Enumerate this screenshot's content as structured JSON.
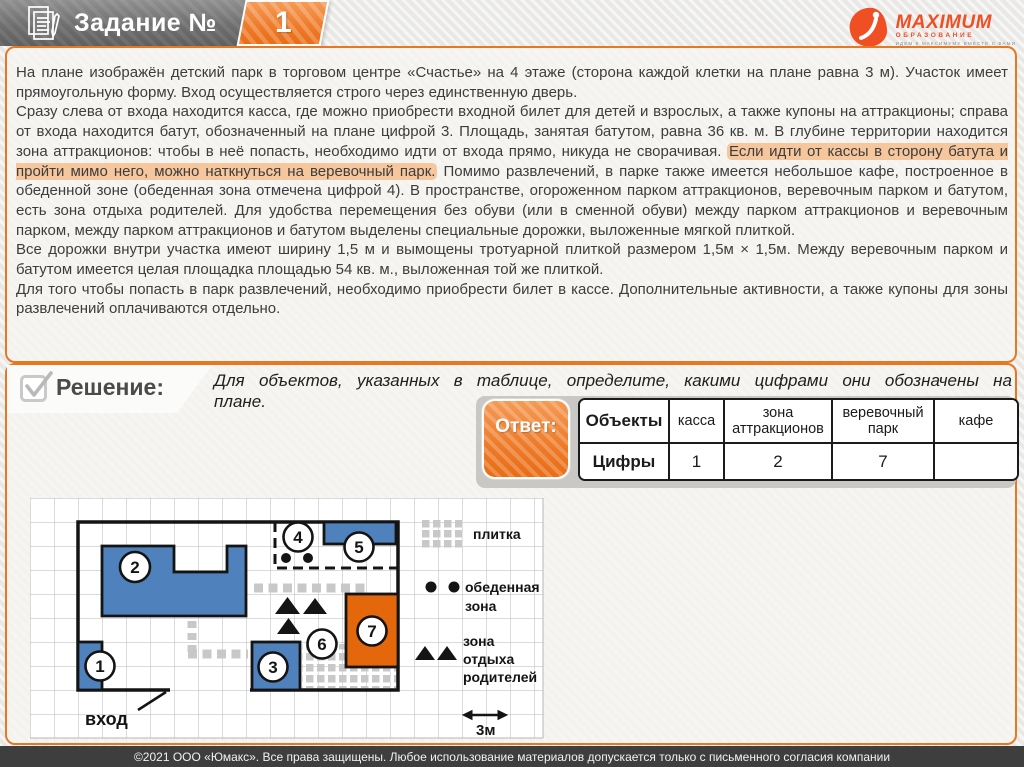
{
  "header": {
    "task_label": "Задание №",
    "task_number": "1",
    "logo_brand": "MAXIMUM",
    "logo_sub": "ОБРАЗОВАНИЕ",
    "logo_tagline": "ИДЕМ К МАКСИМУМУ ВМЕСТЕ С ВАМИ"
  },
  "task": {
    "paragraphs": [
      {
        "runs": [
          {
            "t": "На плане изображён детский парк в торговом центре «Счастье» на 4 этаже (сторона каждой клетки на плане равна 3 м). Участок имеет прямоугольную форму. Вход осуществляется строго через единственную дверь."
          }
        ]
      },
      {
        "runs": [
          {
            "t": "Сразу слева от входа находится касса, где можно приобрести входной билет для детей и взрослых, а также купоны на аттракционы; справа от входа находится батут, обозначенный на плане цифрой 3. Площадь, занятая батутом, равна 36 кв. м. В глубине территории находится зона аттракционов: чтобы в неё попасть, необходимо идти от входа прямо, никуда не сворачивая. "
          },
          {
            "t": "Если идти от кассы в сторону батута и пройти мимо него, можно наткнуться на веревочный парк.",
            "hl": true
          },
          {
            "t": " Помимо развлечений, в парке также имеется небольшое кафе, построенное в обеденной зоне (обеденная зона отмечена цифрой 4). В пространстве, огороженном парком аттракционов, веревочным парком и батутом, есть зона отдыха родителей. Для удобства перемещения без обуви (или в сменной обуви) между парком аттракционов и веревочным парком, между парком аттракционов и батутом выделены специальные дорожки, выложенные мягкой плиткой."
          }
        ]
      },
      {
        "runs": [
          {
            "t": "Все дорожки внутри участка имеют ширину 1,5 м и вымощены тротуарной плиткой размером 1,5м × 1,5м.  Между веревочным парком и батутом имеется целая площадка площадью 54 кв. м., выложенная той же плиткой."
          }
        ]
      },
      {
        "runs": [
          {
            "t": "Для того чтобы попасть в парк развлечений, необходимо приобрести билет в кассе. Дополнительные активности, а также купоны для зоны развлечений оплачиваются отдельно."
          }
        ]
      }
    ]
  },
  "solution": {
    "label": "Решение:",
    "prompt_line1": "Для объектов, указанных в таблице, определите, какими цифрами они обозначены на",
    "prompt_line2": "плане."
  },
  "answer": {
    "button_label": "Ответ:",
    "table": {
      "row1_label": "Объекты",
      "row2_label": "Цифры",
      "columns": [
        {
          "name": "касса",
          "digit": "1"
        },
        {
          "name": "зона аттракционов",
          "digit": "2"
        },
        {
          "name": "веревочный парк",
          "digit": "7"
        },
        {
          "name": "кафе",
          "digit": ""
        }
      ]
    }
  },
  "plan": {
    "circle_numbers": [
      "1",
      "2",
      "3",
      "4",
      "5",
      "6",
      "7"
    ],
    "entrance_label": "вход",
    "scale_label": "3м",
    "legend": {
      "tile": "плитка",
      "dining_line1": "обеденная",
      "dining_line2": "зона",
      "rest_line1": "зона",
      "rest_line2": "отдыха",
      "rest_line3": "родителей"
    },
    "colors": {
      "blue": "#4f81bd",
      "orange": "#e5670c",
      "grid": "#b7b7b7",
      "path_gray": "#c8c8c8"
    }
  },
  "footer": {
    "copyright": "©2021 ООО «Юмакс». Все права защищены. Любое использование материалов допускается только с  письменного согласия компании"
  }
}
